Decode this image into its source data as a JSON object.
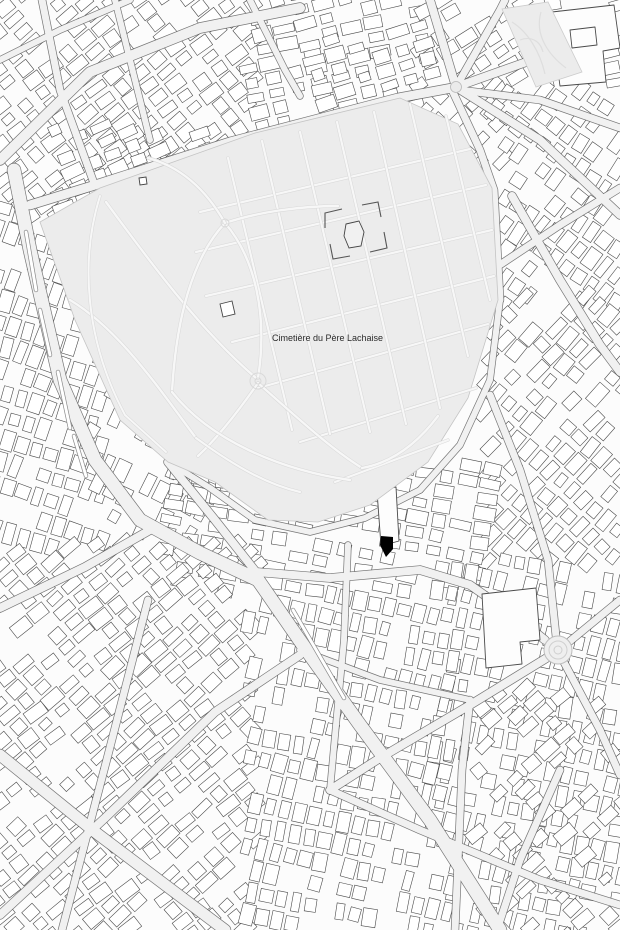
{
  "map": {
    "seed": 42,
    "canvas": {
      "width": 620,
      "height": 930
    },
    "colors": {
      "bg_blocks": "#fcfcfc",
      "street_fill": "#f1f1f1",
      "street_casing": "#5f5f5f",
      "building_fill": "#ffffff",
      "building_stroke": "#4a4a4a",
      "cemetery_fill": "#ececec",
      "cemetery_stroke": "#c4c4c4",
      "path_fill": "#f7f7f7",
      "path_casing": "#d9d9d9",
      "median_fill": "#ffffff",
      "median_casing": "#8a8a8a",
      "landmark_fill": "#fdfdfd",
      "monument_stroke": "#555555",
      "label_color": "#2b2b2b",
      "marker_color": "#000000",
      "plaza_fill": "#ebebeb",
      "plaza_stroke": "#b8b8b8"
    },
    "labels": {
      "cemetery": {
        "text": "Cimetière du Père Lachaise",
        "x": 272,
        "y": 341,
        "size": 9
      }
    },
    "marker": {
      "points": "381,536 393,537 393,549 386,557 380,545"
    },
    "cemetery": {
      "outline": "40,222 100,188 255,133 400,98 458,124 492,188 498,300 468,398 428,462 370,505 318,522 268,520 215,482 168,462 120,420 75,320",
      "paths": [
        {
          "d": "M200,212 L470,149",
          "w": 2.2
        },
        {
          "d": "M196,252 L486,185",
          "w": 2.2
        },
        {
          "d": "M206,296 L492,230",
          "w": 2.2
        },
        {
          "d": "M232,342 L494,276",
          "w": 2.2
        },
        {
          "d": "M258,388 L488,324",
          "w": 2.2
        },
        {
          "d": "M300,442 L476,388",
          "w": 2.2
        },
        {
          "d": "M335,482 L448,440",
          "w": 2.2
        },
        {
          "d": "M262,141 L330,434",
          "w": 2.2
        },
        {
          "d": "M300,132 L370,432",
          "w": 2.2
        },
        {
          "d": "M337,122 L406,424",
          "w": 2.2
        },
        {
          "d": "M374,112 L440,408",
          "w": 2.2
        },
        {
          "d": "M410,104 L468,356",
          "w": 2.2
        },
        {
          "d": "M446,116 L490,300",
          "w": 2.2
        },
        {
          "d": "M228,158 L292,430",
          "w": 2.2
        },
        {
          "d": "M106,202 C150,262 200,330 256,378",
          "w": 2.4
        },
        {
          "d": "M70,300 C120,330 160,390 196,438",
          "w": 2.4
        },
        {
          "d": "M225,223 C255,258 268,315 258,378",
          "w": 2.4
        },
        {
          "d": "M225,223 C192,258 176,320 172,392",
          "w": 2.4
        },
        {
          "d": "M225,223 C258,212 300,206 338,206",
          "w": 2.4
        },
        {
          "d": "M225,223 C204,186 178,166 148,158",
          "w": 2.4
        },
        {
          "d": "M258,383 C300,420 330,448 362,468",
          "w": 2.4
        },
        {
          "d": "M258,383 C235,416 215,440 198,456",
          "w": 2.4
        },
        {
          "d": "M172,392 C210,440 280,470 350,480",
          "w": 2.4
        },
        {
          "d": "M362,468 C395,462 420,440 438,416",
          "w": 2.4
        },
        {
          "d": "M196,438 C240,470 270,485 300,492",
          "w": 2.2
        },
        {
          "d": "M100,196 C80,260 85,340 125,415 L166,452",
          "w": 2.0
        }
      ],
      "nodes": [
        {
          "cx": 225,
          "cy": 223,
          "r": 4
        },
        {
          "cx": 258,
          "cy": 381,
          "r": 8
        },
        {
          "cx": 258,
          "cy": 381,
          "r": 3
        }
      ],
      "monument": {
        "walls": [
          "M325,228 L325,213 L342,209",
          "M362,205 L378,202 L381,217",
          "M384,232 L387,248 L370,252",
          "M350,256 L333,259 L330,244"
        ],
        "blob": "M346,224 L359,221 L364,232 L361,246 L349,248 L344,236 Z"
      },
      "features": [
        {
          "points": "220,304 232,301 235,314 223,317"
        },
        {
          "points": "139,178 146,177 147,184 140,185"
        }
      ]
    },
    "park": {
      "outline": "502,9 548,2 582,72 536,87",
      "paths": [
        "M512,22 C528,32 540,52 545,74",
        "M541,12 C534,36 550,56 566,68",
        "M520,40 C530,36 540,40 543,52"
      ]
    },
    "plazas": {
      "gambetta": {
        "cx": 456,
        "cy": 87,
        "r": 5.5
      },
      "edith_piaf": {
        "cx": 558,
        "cy": 650,
        "rings": [
          14,
          9,
          4
        ]
      }
    },
    "landmarks": [
      {
        "d": "M552,12 L614,5 L620,48 L603,51 L606,82 L560,86 L555,50 Z"
      },
      {
        "d": "M570,30 L595,27 L597,45 L572,48 Z"
      },
      {
        "d": "M482,594 L536,588 L540,640 L520,642 L522,664 L486,668 Z"
      },
      {
        "d": "M377,491 L396,487 L399,541 L381,546 Z"
      }
    ],
    "streets": [
      {
        "w": 13,
        "p": [
          [
            14,
            170
          ],
          [
            30,
            250
          ],
          [
            60,
            380
          ],
          [
            95,
            460
          ],
          [
            140,
            520
          ],
          [
            200,
            553
          ],
          [
            258,
            580
          ],
          [
            305,
            648
          ],
          [
            360,
            725
          ],
          [
            430,
            820
          ],
          [
            500,
            930
          ]
        ]
      },
      {
        "w": 9,
        "p": [
          [
            30,
            205
          ],
          [
            92,
            186
          ],
          [
            230,
            142
          ],
          [
            398,
            98
          ],
          [
            452,
            88
          ]
        ]
      },
      {
        "w": 10,
        "p": [
          [
            0,
            160
          ],
          [
            90,
            72
          ],
          [
            200,
            28
          ],
          [
            300,
            8
          ]
        ]
      },
      {
        "w": 7,
        "p": [
          [
            95,
            186
          ],
          [
            60,
            90
          ],
          [
            42,
            0
          ]
        ]
      },
      {
        "w": 6,
        "p": [
          [
            250,
            0
          ],
          [
            285,
            70
          ],
          [
            300,
            96
          ]
        ]
      },
      {
        "w": 6,
        "p": [
          [
            0,
            60
          ],
          [
            60,
            30
          ],
          [
            130,
            0
          ]
        ]
      },
      {
        "w": 6,
        "p": [
          [
            115,
            0
          ],
          [
            135,
            80
          ],
          [
            150,
            140
          ]
        ]
      },
      {
        "w": 8,
        "p": [
          [
            456,
            87
          ],
          [
            430,
            0
          ]
        ]
      },
      {
        "w": 7,
        "p": [
          [
            456,
            87
          ],
          [
            500,
            10
          ],
          [
            505,
            0
          ]
        ]
      },
      {
        "w": 8,
        "p": [
          [
            456,
            87
          ],
          [
            560,
            50
          ],
          [
            620,
            40
          ]
        ]
      },
      {
        "w": 8,
        "p": [
          [
            456,
            87
          ],
          [
            540,
            140
          ],
          [
            620,
            215
          ]
        ]
      },
      {
        "w": 7,
        "p": [
          [
            460,
            90
          ],
          [
            540,
            100
          ],
          [
            620,
            128
          ]
        ]
      },
      {
        "w": 7,
        "p": [
          [
            452,
            90
          ],
          [
            480,
            150
          ],
          [
            494,
            190
          ],
          [
            500,
            300
          ]
        ]
      },
      {
        "w": 6,
        "p": [
          [
            500,
            300
          ],
          [
            490,
            380
          ],
          [
            460,
            445
          ],
          [
            420,
            490
          ]
        ]
      },
      {
        "w": 6,
        "p": [
          [
            420,
            490
          ],
          [
            365,
            518
          ],
          [
            310,
            532
          ],
          [
            255,
            520
          ],
          [
            210,
            488
          ],
          [
            168,
            462
          ]
        ]
      },
      {
        "w": 8,
        "p": [
          [
            168,
            462
          ],
          [
            215,
            520
          ],
          [
            256,
            572
          ]
        ]
      },
      {
        "w": 8,
        "p": [
          [
            256,
            572
          ],
          [
            330,
            578
          ],
          [
            420,
            570
          ],
          [
            470,
            585
          ],
          [
            520,
            620
          ],
          [
            545,
            640
          ]
        ]
      },
      {
        "w": 6,
        "p": [
          [
            348,
            545
          ],
          [
            344,
            640
          ],
          [
            336,
            725
          ],
          [
            330,
            790
          ]
        ]
      },
      {
        "w": 8,
        "p": [
          [
            512,
            196
          ],
          [
            560,
            280
          ],
          [
            600,
            345
          ],
          [
            620,
            372
          ]
        ]
      },
      {
        "w": 7,
        "p": [
          [
            480,
            278
          ],
          [
            560,
            225
          ],
          [
            620,
            188
          ]
        ]
      },
      {
        "w": 7,
        "p": [
          [
            490,
            395
          ],
          [
            520,
            470
          ],
          [
            548,
            560
          ],
          [
            556,
            636
          ]
        ]
      },
      {
        "w": 7,
        "p": [
          [
            558,
            651
          ],
          [
            620,
            600
          ]
        ]
      },
      {
        "w": 7,
        "p": [
          [
            558,
            651
          ],
          [
            600,
            730
          ],
          [
            620,
            775
          ]
        ]
      },
      {
        "w": 8,
        "p": [
          [
            558,
            651
          ],
          [
            470,
            705
          ],
          [
            380,
            758
          ],
          [
            330,
            790
          ]
        ]
      },
      {
        "w": 8,
        "p": [
          [
            0,
            608
          ],
          [
            85,
            567
          ],
          [
            150,
            530
          ]
        ]
      },
      {
        "w": 11,
        "p": [
          [
            0,
            755
          ],
          [
            95,
            832
          ],
          [
            225,
            930
          ]
        ]
      },
      {
        "w": 8,
        "p": [
          [
            0,
            915
          ],
          [
            105,
            818
          ],
          [
            215,
            712
          ],
          [
            300,
            655
          ]
        ]
      },
      {
        "w": 7,
        "p": [
          [
            148,
            600
          ],
          [
            108,
            755
          ],
          [
            62,
            930
          ]
        ]
      },
      {
        "w": 6,
        "p": [
          [
            300,
            650
          ],
          [
            380,
            680
          ],
          [
            470,
            700
          ]
        ]
      },
      {
        "w": 7,
        "p": [
          [
            470,
            700
          ],
          [
            462,
            770
          ],
          [
            455,
            930
          ]
        ]
      },
      {
        "w": 7,
        "p": [
          [
            560,
            770
          ],
          [
            520,
            860
          ],
          [
            497,
            930
          ]
        ]
      },
      {
        "w": 7,
        "p": [
          [
            330,
            790
          ],
          [
            420,
            830
          ],
          [
            540,
            880
          ],
          [
            620,
            905
          ]
        ]
      }
    ],
    "medians": [
      {
        "x1": 26,
        "y1": 232,
        "x2": 36,
        "y2": 290
      },
      {
        "x1": 40,
        "y1": 310,
        "x2": 50,
        "y2": 355
      },
      {
        "x1": 58,
        "y1": 372,
        "x2": 70,
        "y2": 428
      },
      {
        "x1": 74,
        "y1": 436,
        "x2": 86,
        "y2": 476
      },
      {
        "x1": 293,
        "y1": 610,
        "x2": 344,
        "y2": 698
      }
    ],
    "fabric_zones": [
      {
        "x": 0,
        "y": 0,
        "w": 252,
        "h": 212,
        "angle": -38,
        "d": 1.0
      },
      {
        "x": 252,
        "y": 0,
        "w": 170,
        "h": 132,
        "angle": -14,
        "d": 1.0
      },
      {
        "x": 424,
        "y": 0,
        "w": 120,
        "h": 92,
        "angle": -32,
        "d": 0.8
      },
      {
        "x": 540,
        "y": 0,
        "w": 80,
        "h": 92,
        "angle": -12,
        "d": 0.5
      },
      {
        "x": 424,
        "y": 92,
        "w": 80,
        "h": 80,
        "angle": -45,
        "d": 0.8
      },
      {
        "x": 500,
        "y": 92,
        "w": 120,
        "h": 212,
        "angle": -55,
        "d": 1.0
      },
      {
        "x": 488,
        "y": 300,
        "w": 132,
        "h": 262,
        "angle": -48,
        "d": 1.0
      },
      {
        "x": 0,
        "y": 214,
        "w": 100,
        "h": 336,
        "angle": -72,
        "d": 1.0
      },
      {
        "x": 96,
        "y": 380,
        "w": 110,
        "h": 150,
        "angle": -62,
        "d": 0.7
      },
      {
        "x": 60,
        "y": 132,
        "w": 160,
        "h": 76,
        "angle": -23,
        "d": 0.9
      },
      {
        "x": 300,
        "y": 40,
        "w": 130,
        "h": 60,
        "angle": -16,
        "d": 0.8
      },
      {
        "x": 168,
        "y": 470,
        "w": 330,
        "h": 118,
        "angle": 10,
        "d": 0.9
      },
      {
        "x": 0,
        "y": 548,
        "w": 252,
        "h": 382,
        "angle": -40,
        "d": 1.0
      },
      {
        "x": 252,
        "y": 600,
        "w": 196,
        "h": 330,
        "angle": -78,
        "d": 0.9
      },
      {
        "x": 440,
        "y": 560,
        "w": 180,
        "h": 370,
        "angle": -78,
        "d": 0.9
      },
      {
        "x": 480,
        "y": 690,
        "w": 140,
        "h": 240,
        "angle": -42,
        "d": 0.6
      }
    ]
  }
}
